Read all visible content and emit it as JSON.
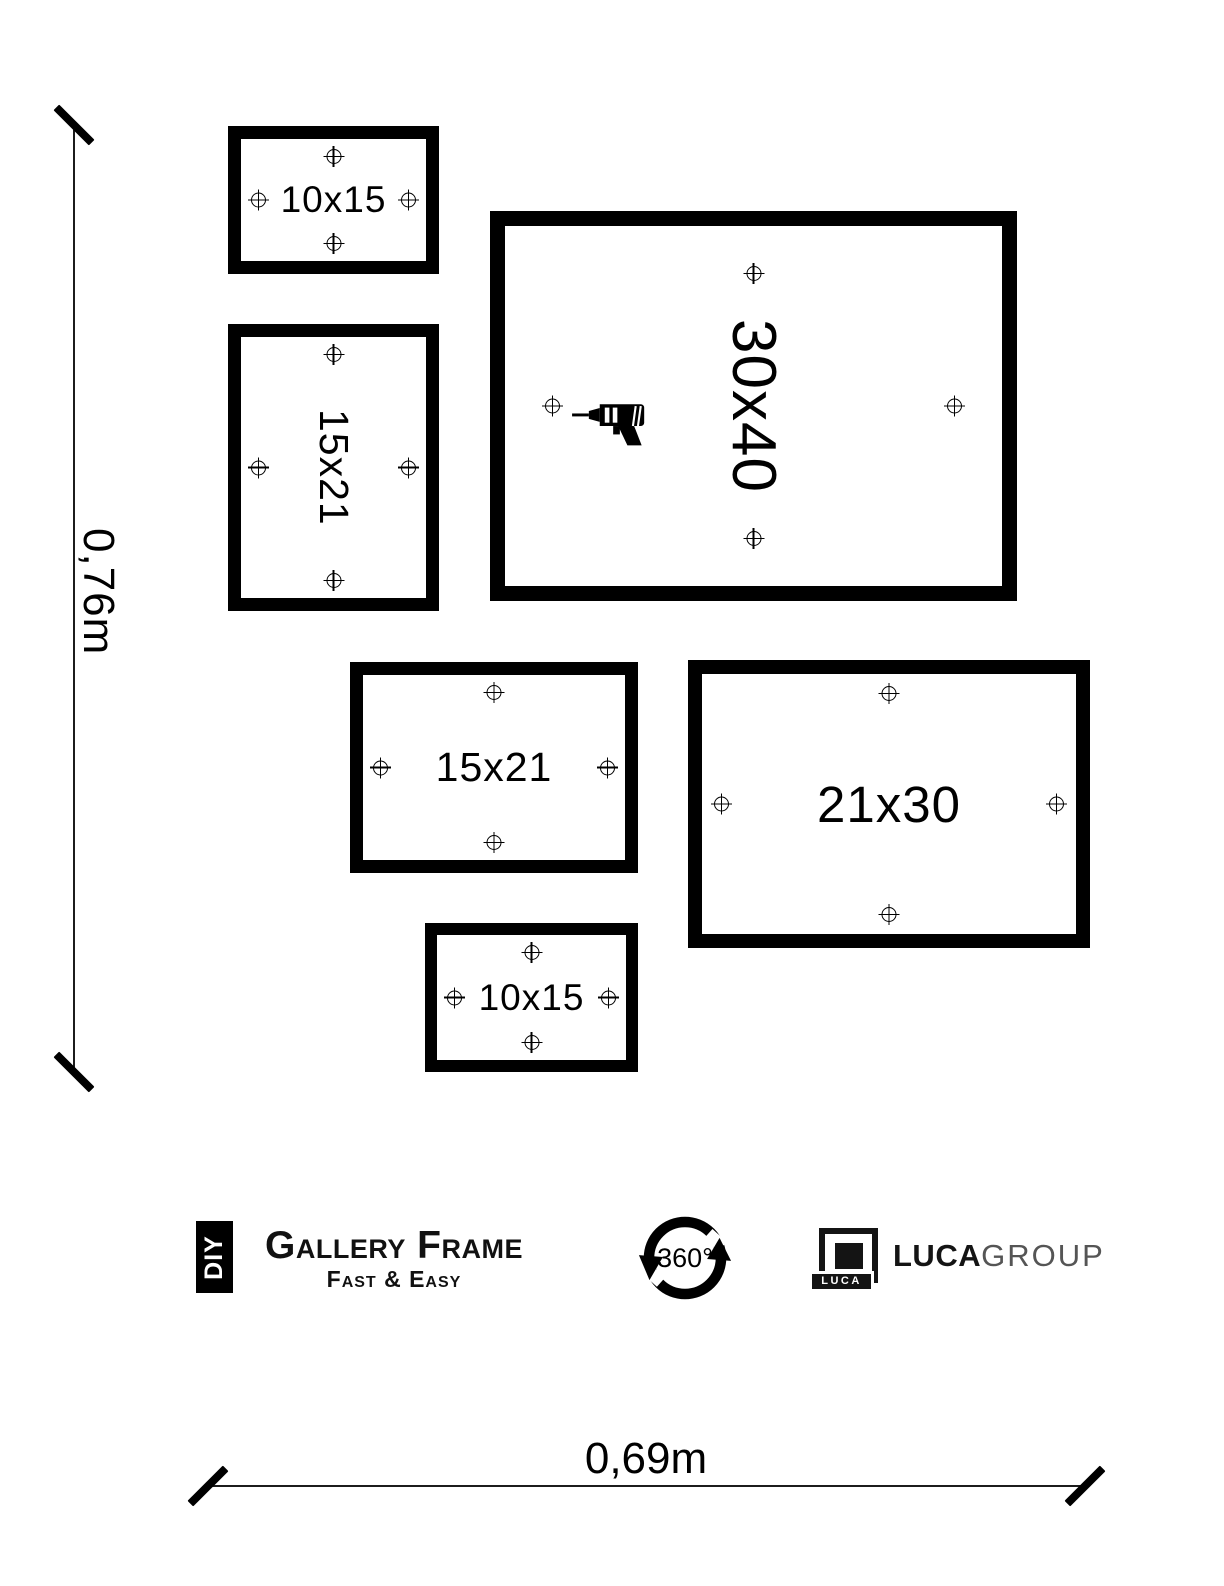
{
  "diagram": {
    "frames": [
      {
        "label": "10x15"
      },
      {
        "label": "15x21"
      },
      {
        "label": "30x40"
      },
      {
        "label": "15x21"
      },
      {
        "label": "21x30"
      },
      {
        "label": "10x15"
      }
    ],
    "dimensions": {
      "height_label": "0,76m",
      "width_label": "0,69m"
    }
  },
  "branding": {
    "diy": {
      "box": "DIY",
      "title": "Gallery Frame",
      "subtitle": "Fast & Easy"
    },
    "rotation": {
      "label": "360°"
    },
    "luca": {
      "badge": "LUCA",
      "bold": "LUCA",
      "light": "GROUP"
    }
  },
  "colors": {
    "ink": "#000000",
    "bg": "#ffffff",
    "group_gray": "#555555"
  },
  "icons": {
    "marker": "crosshair-target",
    "drill": "power-drill",
    "rotation": "circular-arrows-360"
  }
}
